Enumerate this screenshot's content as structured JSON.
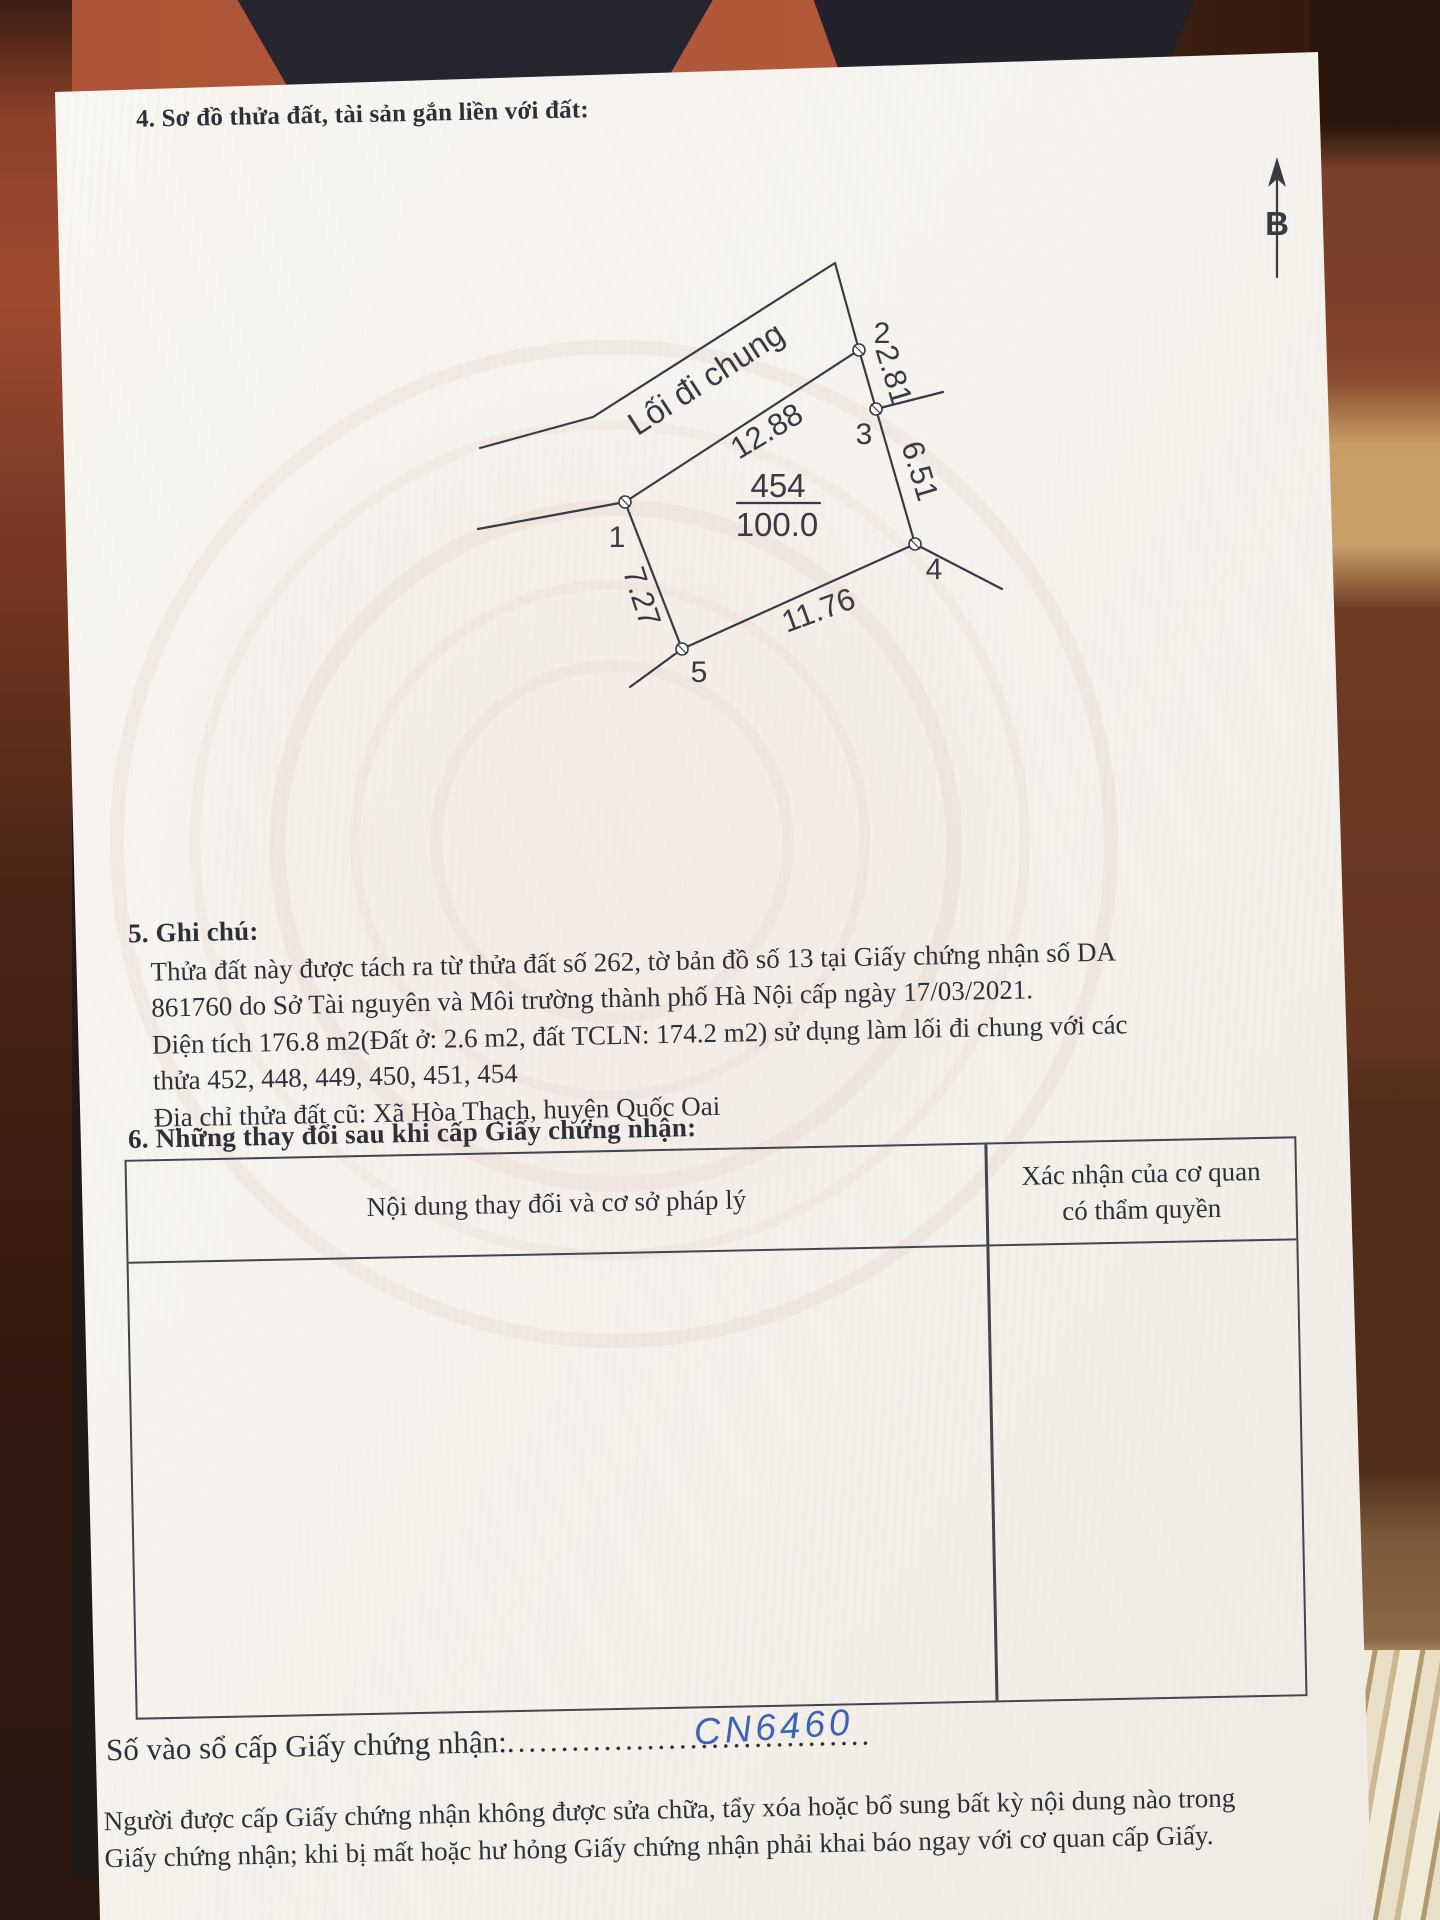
{
  "colors": {
    "ink": "#2e3038",
    "line": "#43444c",
    "handwriting": "#3f62b5"
  },
  "section4": {
    "title": "4. Sơ đồ thửa đất, tài sản gắn liền với đất:"
  },
  "diagram": {
    "path_label": "Lối đi chung",
    "parcel_number": "454",
    "parcel_area": "100.0",
    "north_label": "B",
    "vertices": [
      "1",
      "2",
      "3",
      "4",
      "5"
    ],
    "edges": {
      "v1_v2": "12.88",
      "v2_v3": "2.81",
      "v3_v4": "6.51",
      "v4_v5": "11.76",
      "v5_v1": "7.27"
    }
  },
  "section5": {
    "title": "5. Ghi chú:",
    "lines": [
      "Thửa đất này được tách ra từ thửa đất số 262, tờ bản đồ số 13 tại Giấy chứng nhận số DA",
      "861760 do Sở Tài nguyên và Môi trường thành phố Hà Nội cấp ngày 17/03/2021.",
      "Diện tích 176.8 m2(Đất ở: 2.6 m2, đất TCLN: 174.2 m2) sử dụng làm lối đi chung với các",
      "thửa 452, 448, 449, 450, 451, 454",
      "Địa chỉ thửa đất cũ: Xã Hòa Thạch, huyện Quốc Oai"
    ]
  },
  "section6": {
    "title": "6. Những thay đổi sau khi cấp Giấy chứng nhận:",
    "table": {
      "col1_header": "Nội dung thay đổi và cơ sở pháp lý",
      "col2_header_line1": "Xác nhận của cơ quan",
      "col2_header_line2": "có thẩm quyền"
    }
  },
  "registry": {
    "label": "Số vào sổ cấp Giấy chứng nhận:",
    "dots": "..................................",
    "value": "CN6460"
  },
  "footer": {
    "lines": [
      "Người được cấp Giấy chứng nhận không được sửa chữa, tẩy xóa hoặc bổ sung bất kỳ nội dung nào trong",
      "Giấy chứng nhận; khi bị mất hoặc hư hỏng Giấy chứng nhận phải khai báo ngay với cơ quan cấp Giấy."
    ]
  }
}
